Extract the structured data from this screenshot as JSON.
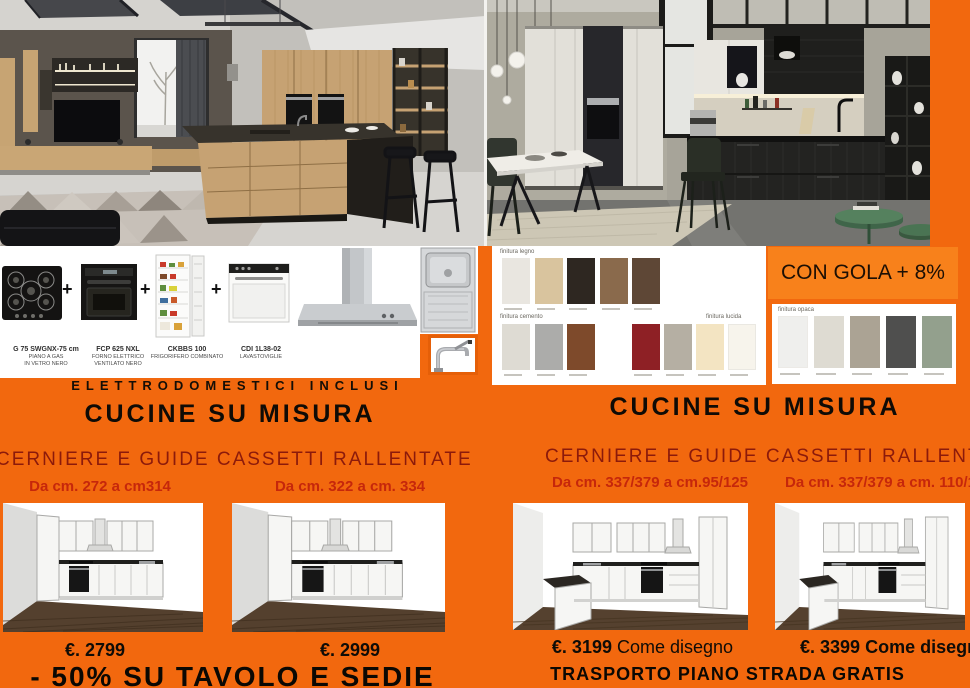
{
  "theme": {
    "background_orange": "#F2680E",
    "badge_orange": "#F8811B",
    "subtitle_dark_red": "#8C1A0B",
    "dimension_red": "#C6270B",
    "text_black": "#0F0C07"
  },
  "appliance_bar": {
    "plus": "+",
    "included_banner": "ELETTRODOMESTICI INCLUSI",
    "items": [
      {
        "model": "G 75 SWGNX-75 cm",
        "desc1": "PIANO A GAS",
        "desc2": "IN VETRO NERO"
      },
      {
        "model": "FCP 625 NXL",
        "desc1": "FORNO ELETTRICO",
        "desc2": "VENTILATO NERO"
      },
      {
        "model": "CKBBS 100",
        "desc1": "FRIGORIFERO COMBINATO",
        "desc2": ""
      },
      {
        "model": "CDI 1L38-02",
        "desc1": "LAVASTOVIGLIE",
        "desc2": ""
      }
    ]
  },
  "finishes": {
    "legno_label": "finitura legno",
    "cemento_label": "finitura cemento",
    "lucida_label": "finitura lucida",
    "opaca_label": "finitura opaca",
    "legno_colors": [
      "#E9E6E0",
      "#D9C49E",
      "#2E2721",
      "#8A6A4C",
      "#5E4736"
    ],
    "cemento_colors": [
      "#DEDBD3",
      "#ACACAA",
      "#7E4A2B"
    ],
    "lucida_colors": [
      "#8E2025",
      "#B5AFA3",
      "#F3E4C2",
      "#F7F4EC"
    ],
    "opaca_colors": [
      "#EFEFED",
      "#DEDBD2",
      "#ABA394",
      "#4F4F4E",
      "#93A08D"
    ]
  },
  "badge": {
    "gola": "CON GOLA + 8%"
  },
  "left_column": {
    "title": "CUCINE SU MISURA",
    "subtitle": "CERNIERE E GUIDE CASSETTI RALLENTATE",
    "dim1": "Da cm. 272  a cm314",
    "dim2": "Da cm. 322 a cm. 334",
    "price1": "€. 2799",
    "price2": "€. 2999",
    "promo": "- 50% SU TAVOLO E SEDIE"
  },
  "right_column": {
    "title": "CUCINE SU MISURA",
    "subtitle": "CERNIERE E GUIDE CASSETTI RALLENTATE",
    "dim1": "Da cm. 337/379 a cm.95/125",
    "dim2": "Da cm. 337/379 a cm. 110/1",
    "price1": "€. 3199",
    "note1": "Come disegno",
    "price2": "€. 3399",
    "note2": "Come disegno",
    "promo": "TRASPORTO PIANO STRADA GRATIS"
  }
}
